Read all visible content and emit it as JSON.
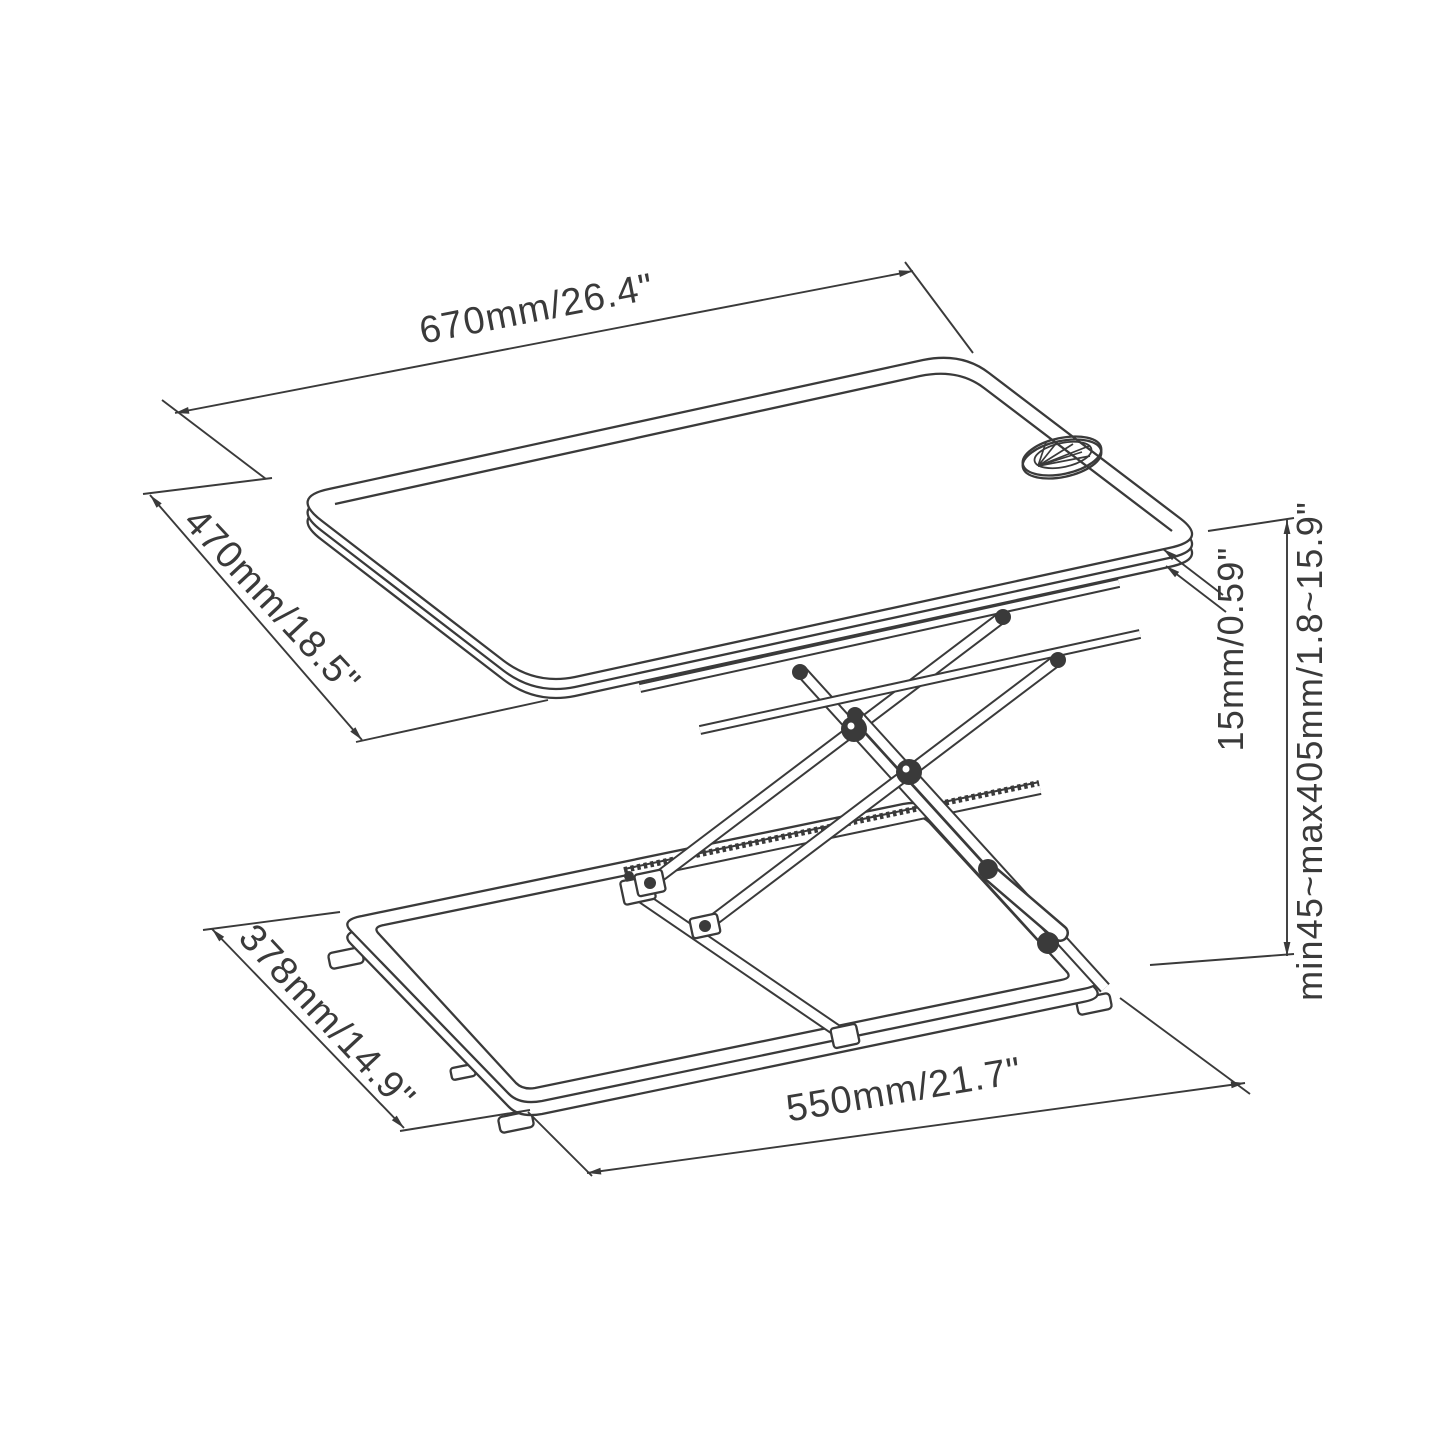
{
  "figure": {
    "type": "technical-dimension-drawing",
    "subject": "height-adjustable standing desk converter with scissor lift",
    "background": "#ffffff",
    "line_color": "#3a3a3a"
  },
  "dimensions": {
    "tabletop_width": "670mm/26.4\"",
    "tabletop_depth": "470mm/18.5\"",
    "tabletop_thickness": "15mm/0.59\"",
    "height_range": "min45~max405mm/1.8~15.9\"",
    "base_depth": "378mm/14.9\"",
    "base_width": "550mm/21.7\""
  }
}
